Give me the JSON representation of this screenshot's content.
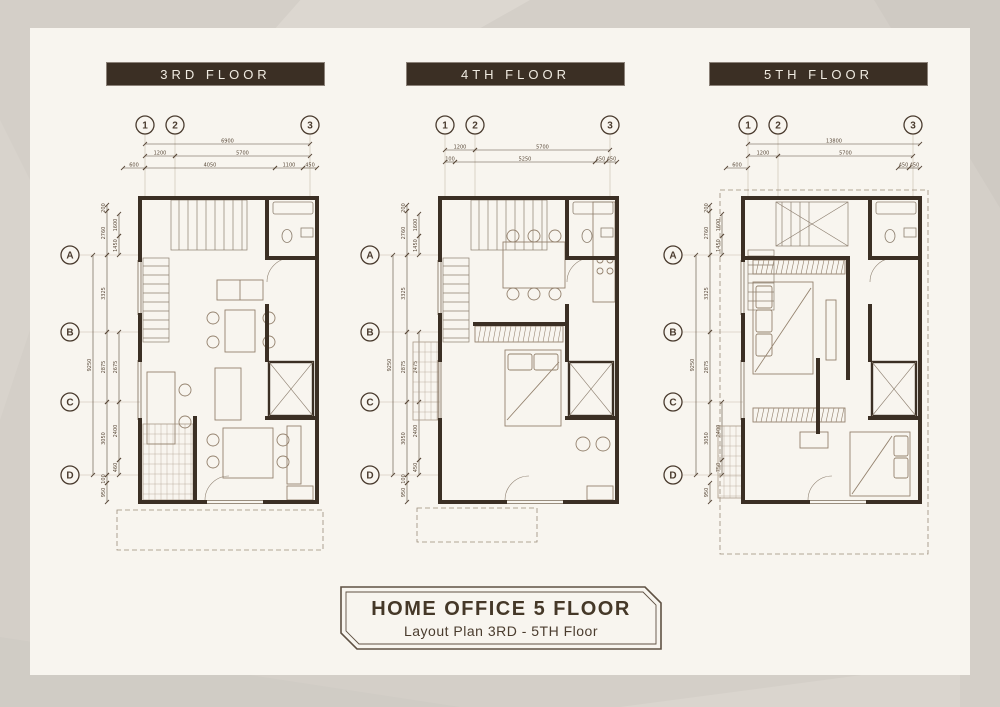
{
  "colors": {
    "background": "#d4cfc8",
    "sheet": "#f8f5ef",
    "wall": "#3b2f24",
    "title_bar_bg": "#3b2f24",
    "title_bar_text": "#f0ebe1",
    "dimension_line": "#5a4a3a",
    "furniture_line": "#94826e",
    "grid_bubble": "#4a3b2e"
  },
  "floors": [
    {
      "title": "3RD FLOOR",
      "grid_columns": [
        "1",
        "2",
        "3"
      ],
      "grid_rows": [
        "A",
        "B",
        "C",
        "D"
      ],
      "dim_labels": [
        "6900",
        "1200",
        "5700",
        "600",
        "4050",
        "1100",
        "450",
        "9250",
        "3325",
        "2875",
        "3050",
        "200",
        "2760",
        "1600",
        "1450",
        "2675",
        "2400",
        "460",
        "100",
        "950"
      ]
    },
    {
      "title": "4TH FLOOR",
      "grid_columns": [
        "1",
        "2",
        "3"
      ],
      "grid_rows": [
        "A",
        "B",
        "C",
        "D"
      ],
      "dim_labels": [
        "1200",
        "5700",
        "100",
        "5250",
        "450",
        "450",
        "9250",
        "3325",
        "2875",
        "3050",
        "200",
        "2760",
        "1600",
        "1450",
        "2475",
        "2400",
        "450",
        "100",
        "950"
      ]
    },
    {
      "title": "5TH FLOOR",
      "grid_columns": [
        "1",
        "2",
        "3"
      ],
      "grid_rows": [
        "A",
        "B",
        "C",
        "D"
      ],
      "dim_labels": [
        "13800",
        "1200",
        "5700",
        "600",
        "450",
        "450",
        "9250",
        "3325",
        "2875",
        "3050",
        "200",
        "2760",
        "1600",
        "1450",
        "2400",
        "750",
        "950"
      ]
    }
  ],
  "title_block": {
    "title": "HOME OFFICE 5 FLOOR",
    "subtitle": "Layout Plan 3RD - 5TH Floor"
  }
}
